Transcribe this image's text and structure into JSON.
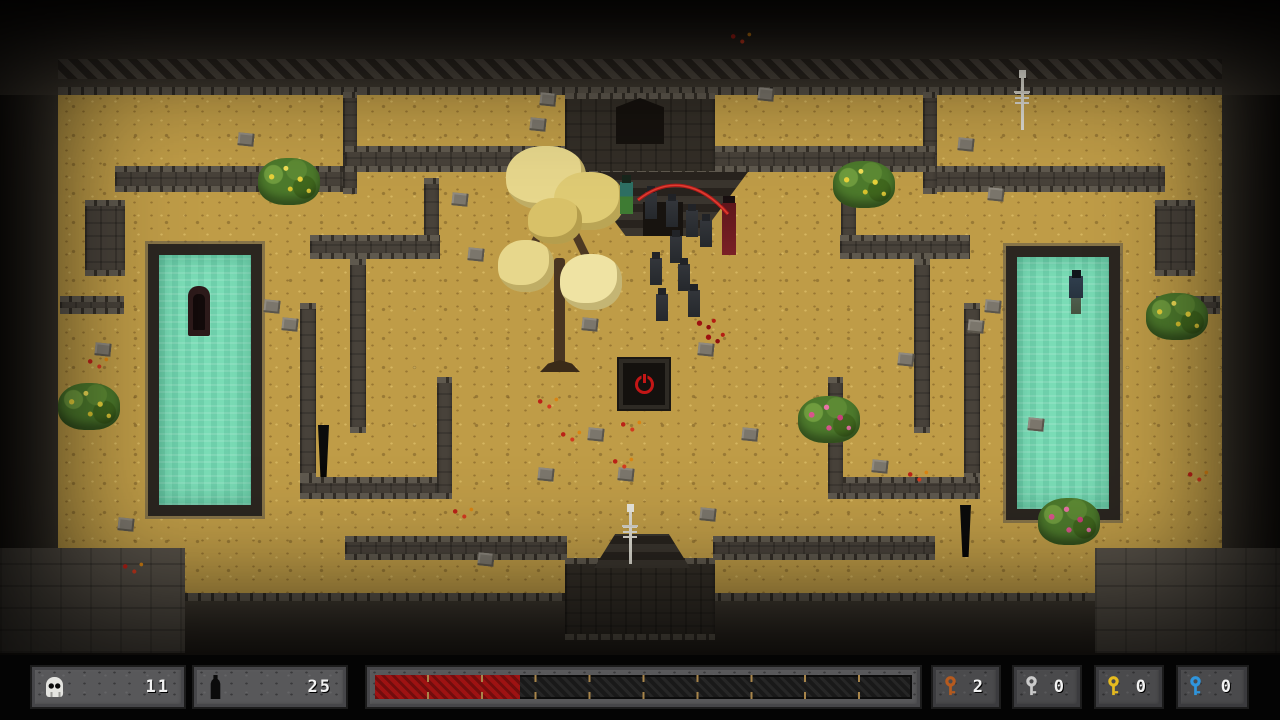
{
  "hud": {
    "skull_count": "11",
    "potion_count": "25",
    "health": {
      "percent": 27,
      "segments": 10,
      "fill_color": "#9e1212",
      "track_color": "#191919",
      "tick_color": "#a8854a"
    },
    "keys": [
      {
        "name": "copper-key",
        "color": "#b65a1e",
        "count": "2"
      },
      {
        "name": "silver-key",
        "color": "#cbcbcb",
        "count": "0"
      },
      {
        "name": "gold-key",
        "color": "#e6bb1f",
        "count": "0"
      },
      {
        "name": "blue-key",
        "color": "#2f95dd",
        "count": "0"
      }
    ]
  },
  "palette": {
    "floor": "#bf9c47",
    "wall": "#48423a",
    "wall_dark": "#332e27",
    "pool_water": "#7adcb6",
    "pool_border": "#2b2620",
    "accent_red": "#c31616"
  },
  "map": {
    "walls": [
      [
        85,
        200,
        40,
        76,
        0
      ],
      [
        60,
        296,
        64,
        18,
        0
      ],
      [
        115,
        166,
        232,
        26,
        0
      ],
      [
        343,
        92,
        14,
        102,
        0
      ],
      [
        345,
        146,
        222,
        26,
        0
      ],
      [
        424,
        178,
        15,
        64,
        0
      ],
      [
        310,
        235,
        130,
        24,
        0
      ],
      [
        350,
        259,
        16,
        174,
        0
      ],
      [
        300,
        303,
        16,
        176,
        0
      ],
      [
        300,
        477,
        146,
        22,
        0
      ],
      [
        437,
        377,
        15,
        122,
        0
      ],
      [
        345,
        536,
        222,
        24,
        0
      ],
      [
        1155,
        200,
        40,
        76,
        0
      ],
      [
        1156,
        296,
        64,
        18,
        0
      ],
      [
        933,
        166,
        232,
        26,
        0
      ],
      [
        923,
        92,
        14,
        102,
        0
      ],
      [
        713,
        146,
        222,
        26,
        0
      ],
      [
        841,
        178,
        15,
        64,
        0
      ],
      [
        840,
        235,
        130,
        24,
        0
      ],
      [
        914,
        259,
        16,
        174,
        0
      ],
      [
        964,
        303,
        16,
        176,
        0
      ],
      [
        834,
        477,
        146,
        22,
        0
      ],
      [
        828,
        377,
        15,
        122,
        0
      ],
      [
        713,
        536,
        222,
        24,
        0
      ],
      [
        565,
        93,
        150,
        84,
        1
      ],
      [
        565,
        558,
        150,
        82,
        1
      ]
    ],
    "pools": [
      [
        148,
        244,
        114,
        272
      ],
      [
        1006,
        246,
        114,
        274
      ]
    ],
    "entities": [
      {
        "type": "zombie",
        "x": 645,
        "y": 192
      },
      {
        "type": "zombie",
        "x": 666,
        "y": 200
      },
      {
        "type": "zombie",
        "x": 686,
        "y": 210
      },
      {
        "type": "zombie",
        "x": 700,
        "y": 220
      },
      {
        "type": "zombie",
        "x": 670,
        "y": 236
      },
      {
        "type": "zombie",
        "x": 650,
        "y": 258
      },
      {
        "type": "zombie",
        "x": 678,
        "y": 264
      },
      {
        "type": "zombie",
        "x": 688,
        "y": 290
      },
      {
        "type": "zombie",
        "x": 656,
        "y": 294
      },
      {
        "type": "green-hero",
        "x": 620,
        "y": 182
      },
      {
        "type": "cultist",
        "x": 722,
        "y": 203
      },
      {
        "type": "shadow-figure",
        "x": 318,
        "y": 425
      },
      {
        "type": "shadow-figure",
        "x": 960,
        "y": 505
      },
      {
        "type": "skeleton",
        "x": 1014,
        "y": 78
      },
      {
        "type": "skeleton",
        "x": 622,
        "y": 512
      },
      {
        "type": "sarcophagus",
        "x": 188,
        "y": 286
      },
      {
        "type": "drowned",
        "x": 1066,
        "y": 270
      },
      {
        "type": "bush dots-yellow",
        "x": 258,
        "y": 158
      },
      {
        "type": "bush dots-yellow",
        "x": 833,
        "y": 161
      },
      {
        "type": "bush dots-yellow",
        "x": 1146,
        "y": 293
      },
      {
        "type": "bush dots-yellow",
        "x": 58,
        "y": 383
      },
      {
        "type": "bush dots-pink",
        "x": 798,
        "y": 396
      },
      {
        "type": "bush dots-pink",
        "x": 1038,
        "y": 498
      },
      {
        "type": "blood",
        "x": 693,
        "y": 316
      },
      {
        "type": "blood",
        "x": 702,
        "y": 330
      }
    ],
    "stones": [
      [
        95,
        343
      ],
      [
        118,
        518
      ],
      [
        238,
        133
      ],
      [
        452,
        193
      ],
      [
        468,
        248
      ],
      [
        540,
        93
      ],
      [
        582,
        318
      ],
      [
        698,
        343
      ],
      [
        588,
        428
      ],
      [
        538,
        468
      ],
      [
        618,
        468
      ],
      [
        478,
        553
      ],
      [
        758,
        88
      ],
      [
        958,
        138
      ],
      [
        988,
        188
      ],
      [
        1028,
        418
      ],
      [
        898,
        353
      ],
      [
        742,
        428
      ],
      [
        264,
        300
      ],
      [
        282,
        318
      ],
      [
        985,
        300
      ],
      [
        968,
        320
      ],
      [
        700,
        508
      ],
      [
        530,
        118
      ],
      [
        872,
        460
      ]
    ],
    "flowers": [
      [
        85,
        355
      ],
      [
        535,
        395
      ],
      [
        558,
        428
      ],
      [
        610,
        455
      ],
      [
        450,
        505
      ],
      [
        1185,
        468
      ],
      [
        728,
        30
      ],
      [
        618,
        418
      ],
      [
        905,
        468
      ],
      [
        120,
        560
      ]
    ]
  }
}
